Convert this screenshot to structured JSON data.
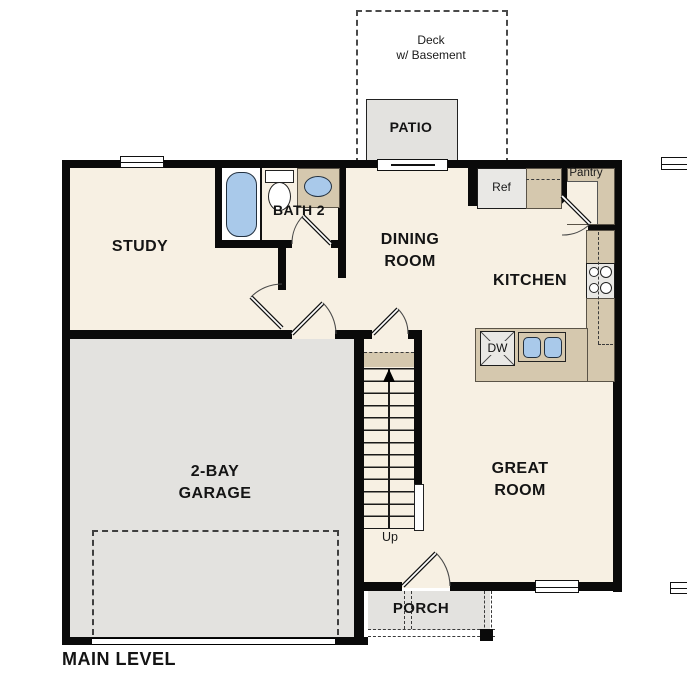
{
  "plan": {
    "title": "MAIN LEVEL",
    "outdoor": {
      "deck": {
        "line1": "Deck",
        "line2": "w/ Basement"
      },
      "patio": "PATIO",
      "porch": "PORCH"
    },
    "rooms": {
      "study": "STUDY",
      "bath2": "BATH 2",
      "dining": {
        "line1": "DINING",
        "line2": "ROOM"
      },
      "kitchen": "KITCHEN",
      "great_room": {
        "line1": "GREAT",
        "line2": "ROOM"
      },
      "garage": {
        "line1": "2-BAY",
        "line2": "GARAGE"
      }
    },
    "features": {
      "refrigerator": "Ref",
      "pantry": "Pantry",
      "dishwasher": "DW",
      "stairs_direction": "Up"
    },
    "colors": {
      "floor": "#F7F0E3",
      "hard": "#E3E2DF",
      "counter": "#D5C8AE",
      "fixture_blue": "#A9C9EA",
      "wall": "#0A0A0A"
    }
  }
}
